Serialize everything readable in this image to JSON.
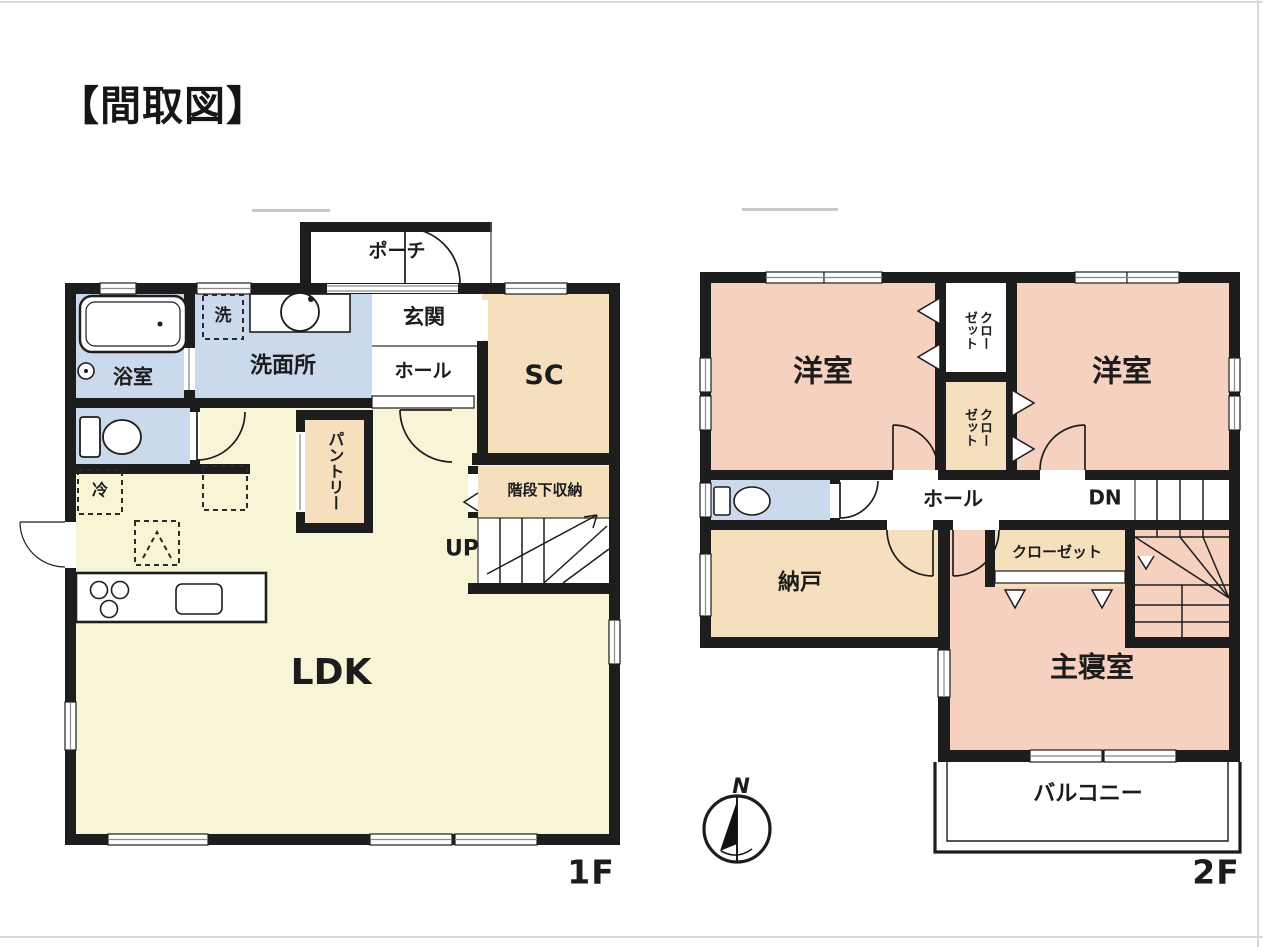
{
  "title": "【間取図】",
  "compass": {
    "north_label": "N"
  },
  "floor1": {
    "floor_label": "1F",
    "porch": "ポーチ",
    "entrance": "玄関",
    "hall": "ホール",
    "shoe_closet": "SC",
    "laundry": "洗",
    "washroom": "洗面所",
    "bathroom": "浴室",
    "pantry": "パントリー",
    "under_stairs_storage": "階段下収納",
    "stairs_up": "UP",
    "fridge": "冷",
    "ldk": "LDK"
  },
  "floor2": {
    "floor_label": "2F",
    "western_room_left": "洋室",
    "western_room_right": "洋室",
    "closet_top": "クローゼット",
    "closet_bottom": "クローゼット",
    "hall": "ホール",
    "stairs_down": "DN",
    "storage_room": "納戸",
    "closet_master": "クローゼット",
    "master_bedroom": "主寝室",
    "balcony": "バルコニー"
  },
  "colors": {
    "wall": "#1d1d1d",
    "ldk_yellow": "#f8f5d6",
    "room_pink": "#f7d1c0",
    "room_peach": "#f6dfbd",
    "room_blue": "#cbd9ed",
    "white": "#ffffff",
    "thin_line": "#8a8a8a"
  }
}
